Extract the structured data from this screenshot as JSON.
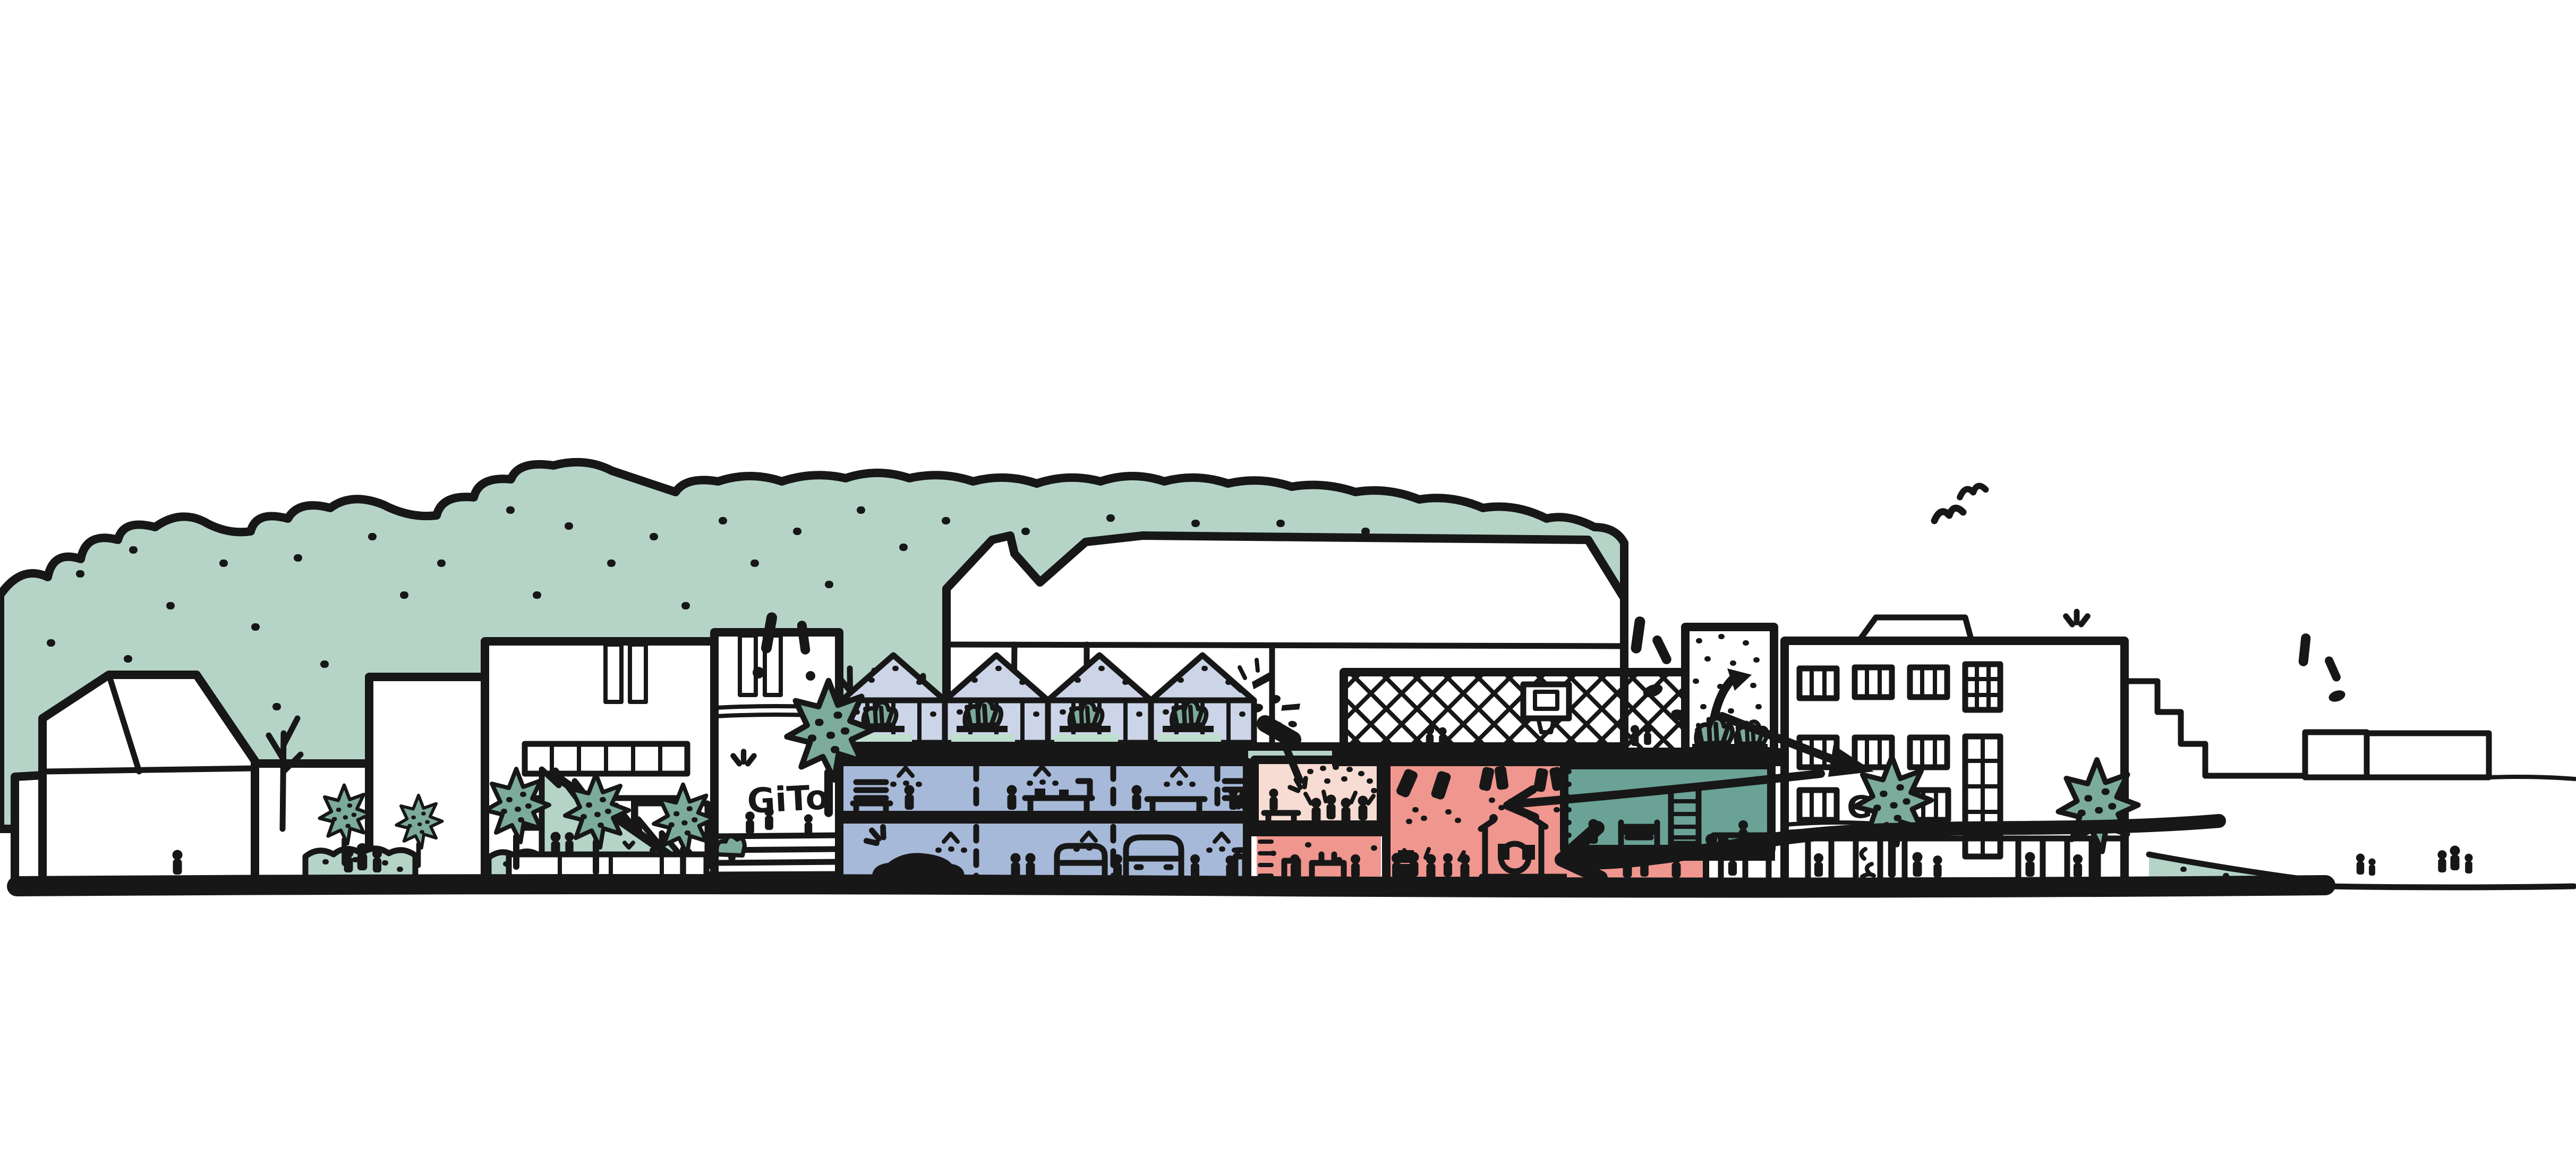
{
  "labels": {
    "gito": "GiTo",
    "gbo": "GBo"
  },
  "palette": {
    "paper": "#ffffff",
    "ink": "#171717",
    "treeLight": "#b5d4c7",
    "treeDark": "#7cab9b",
    "plantLight": "#bfdfce",
    "lavender": "#ccd4e8",
    "blue": "#a7b9d8",
    "pinkPale": "#f7dcd3",
    "red": "#ef968e",
    "teal": "#6aa296"
  },
  "scene": {
    "type": "hand-drawn architectural street section sketch",
    "zones": {
      "rooftop_greenhouses": "lavender",
      "workshop_floors": "blue",
      "small_venue_room": "pinkPale",
      "concert_hall": "red",
      "gym_hall": "teal",
      "vegetation": "treeLight"
    }
  }
}
